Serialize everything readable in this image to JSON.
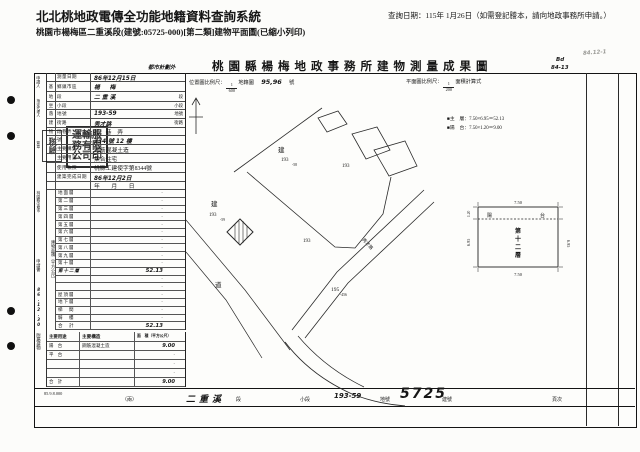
{
  "header": {
    "system_title": "北北桃地政電傳全功能地籍資料查詢系統",
    "query_date": "查詢日期：115年 1月26日（如需登記謄本，請向地政事務所申請。）",
    "subtitle": "桃園市楊梅區二重溪段(建號:05725-000)[第二類]建物平面圖(已縮小列印)"
  },
  "document": {
    "anno_left": "都市計劃外",
    "title": "桃園縣楊梅地政事務所建物測量成果圖",
    "anno_right1": "Bd",
    "anno_right2": "84-13",
    "anno_corner": "84.12-1",
    "scales": {
      "pos_label": "位置圖比例尺：",
      "pos_num": "1",
      "pos_den": "600",
      "pos_suffix": "地籍圖",
      "pos_value": "95,96",
      "pos_unit": "號",
      "plan_label": "平面圖比例尺：",
      "plan_num": "1",
      "plan_den": "200",
      "plan_suffix": "面積計算式"
    },
    "formulas": {
      "bullet": "■",
      "line1": "主　層：7.50×6.95＝52.13",
      "line2": "陽　台：7.50×1.20＝9.00"
    }
  },
  "left_margin": {
    "applicant": "申請人",
    "agent": "指定代理人",
    "sign": "簽章",
    "surveyor_addr": "桃園縣中壢市",
    "application": "申請書",
    "date_stamp": "86.12.30",
    "annex_group": "附屬建物",
    "area_group": "建物面積（平方公尺）",
    "stamp_big": "運輸服務有限公司印",
    "stamp_small": "核驗",
    "print_code": "85.9.8.000"
  },
  "form_rows": [
    {
      "h": 9,
      "g": "",
      "label": "測量日期",
      "value": "86年12月15日",
      "value_cls": "hand",
      "unit": ""
    },
    {
      "h": 10,
      "g": "基",
      "label": "鄉鎮市區",
      "value": "楊　梅",
      "value_cls": "hand big",
      "unit": ""
    },
    {
      "h": 10,
      "g": "地",
      "label": "段",
      "value": "二重溪",
      "value_cls": "hand big",
      "unit": "段"
    },
    {
      "h": 8,
      "g": "坐",
      "label": "小段",
      "value": "",
      "unit": "小段"
    },
    {
      "h": 9,
      "g": "落",
      "label": "地號",
      "value": "193-59",
      "value_cls": "hand",
      "unit": "地號"
    },
    {
      "h": 9,
      "g": "建",
      "label": "街路",
      "value": "秀才路",
      "value_cls": "hand",
      "unit": "街路"
    },
    {
      "h": 8,
      "g": "物",
      "label": "段巷弄",
      "value": "段　巷　弄",
      "unit": ""
    },
    {
      "h": 9,
      "g": "門",
      "label": "號",
      "value": "334 號 12 樓",
      "value_cls": "hand",
      "unit": ""
    },
    {
      "h": 9,
      "g": "",
      "label": "主要構造",
      "value": "鋼筋混凝土造",
      "unit": ""
    },
    {
      "h": 9,
      "g": "",
      "label": "主要用途",
      "value": "集合住宅",
      "unit": ""
    },
    {
      "h": 10,
      "g": "",
      "label": "使用執照",
      "value": "桃縣工建使字第8344號",
      "unit": ""
    },
    {
      "h": 9,
      "g": "",
      "label": "建築完成日期",
      "value": "86年12月2日",
      "value_cls": "hand",
      "unit": ""
    },
    {
      "h": 8,
      "g": "",
      "label": "",
      "value": "年　　月　　日",
      "unit": ""
    }
  ],
  "area_rows": [
    {
      "label": "地面層",
      "value": "·"
    },
    {
      "label": "第二層",
      "value": "·"
    },
    {
      "label": "第三層",
      "value": "·"
    },
    {
      "label": "第四層",
      "value": "·"
    },
    {
      "label": "第五層",
      "value": "·"
    },
    {
      "label": "第六層",
      "value": "·"
    },
    {
      "label": "第七層",
      "value": "·"
    },
    {
      "label": "第八層",
      "value": "·"
    },
    {
      "label": "第九層",
      "value": "·"
    },
    {
      "label": "第十層",
      "value": "·"
    },
    {
      "label": "第十二層",
      "label_cls": "hand",
      "value": "52.13",
      "value_cls": "hand"
    },
    {
      "label": "",
      "value": "·"
    },
    {
      "label": "",
      "value": "·"
    },
    {
      "label": "屋頂層",
      "value": "·"
    },
    {
      "label": "地下層",
      "value": "·"
    },
    {
      "label": "梯　間",
      "value": "·"
    },
    {
      "label": "騎　樓",
      "value": "·"
    },
    {
      "label": "合　計",
      "value": "52.13",
      "value_cls": "hand"
    }
  ],
  "annex": {
    "header": {
      "use": "主要用途",
      "structure": "主要構造",
      "area": "面　積（平方公尺）"
    },
    "rows": [
      {
        "use": "陽　台",
        "structure": "鋼筋混凝土造",
        "area": "9.00",
        "area_cls": "hand"
      },
      {
        "use": "平　台",
        "structure": "",
        "area": "·"
      },
      {
        "use": "",
        "structure": "",
        "area": "·"
      },
      {
        "use": "",
        "structure": "",
        "area": "·"
      },
      {
        "use": "合　計",
        "structure": "",
        "area": "9.00",
        "area_cls": "hand"
      }
    ]
  },
  "notes": [
    {
      "t": "一、本建物平面圖及建物面積係依使用執照 桃縣工建使字第8344號 核發設計圖或竣工平面圖轉繪計算。"
    },
    {
      "t": "二、本建物係 十三 層建物本件測量第 十二 層部分。"
    },
    {
      "t": "三、本成果表供建物登記使用。"
    }
  ],
  "site_plan": {
    "jian1": "建",
    "p1": "193",
    "p1s": "-58",
    "p_right": "193",
    "jian2": "建",
    "p2": "193",
    "p2s": "-59",
    "p_mid": "193",
    "p3": "195",
    "p3s": "-456",
    "road": "道",
    "road_name": "秀才路"
  },
  "floor_plan": {
    "dim_top": "7.50",
    "dim_bottom": "7.50",
    "dim_left": "6.95",
    "dim_right": "6.95",
    "dim_balcony": "1.20",
    "balcony_l": "陽",
    "balcony_r": "台",
    "c1": "第",
    "c2": "十",
    "c3": "二",
    "c4": "層"
  },
  "bottom_strip": {
    "note": "（兩）",
    "section": "二重溪",
    "section_unit": "段",
    "small_section": "小段",
    "parcel": "193-59",
    "parcel_unit": "地號",
    "building": "5725",
    "building_unit": "建號",
    "page": "頁次"
  }
}
